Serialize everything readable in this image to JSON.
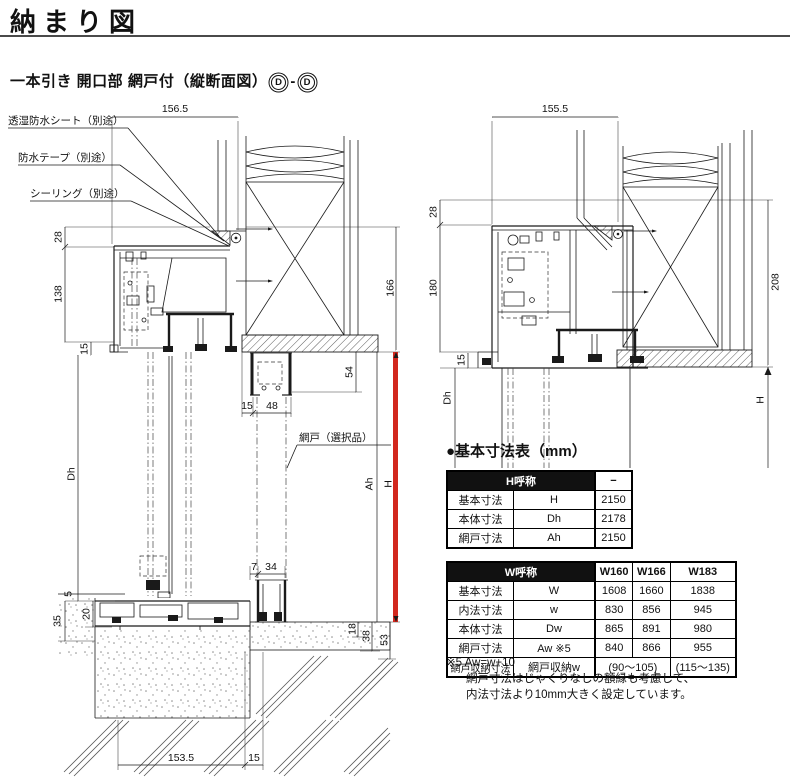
{
  "header": {
    "title": "納まり図"
  },
  "subtitle": {
    "text": "一本引き 開口部 網戸付（縦断面図）",
    "mark1": "D",
    "sep": "-",
    "mark2": "D"
  },
  "left_diagram": {
    "callouts": {
      "sheet": "透湿防水シート（別途）",
      "tape": "防水テープ（別途）",
      "sealing": "シーリング（別途）",
      "screen": "網戸（選択品）"
    },
    "dims": {
      "top_width": "156.5",
      "d28": "28",
      "d138": "138",
      "d15": "15",
      "dh": "Dh",
      "d5": "5",
      "d20": "20",
      "d35": "35",
      "d166": "166",
      "d54": "54",
      "ah": "Ah",
      "h": "H",
      "d18": "18",
      "d38": "38",
      "d53": "53",
      "d48": "48",
      "d7": "7",
      "d34": "34",
      "bottom_width": "153.5"
    }
  },
  "right_diagram": {
    "dims": {
      "top_width": "155.5",
      "d28": "28",
      "d180": "180",
      "d15": "15",
      "dh": "Dh",
      "d208": "208",
      "h": "H"
    }
  },
  "spec": {
    "section_title": "●基本寸法表（mm）",
    "h_table": {
      "header_name": "H呼称",
      "header_col": "−",
      "rows": [
        {
          "label": "基本寸法",
          "symbol": "H",
          "value": "2150"
        },
        {
          "label": "本体寸法",
          "symbol": "Dh",
          "value": "2178"
        },
        {
          "label": "網戸寸法",
          "symbol": "Ah",
          "value": "2150"
        }
      ]
    },
    "w_table": {
      "header_name": "W呼称",
      "cols": [
        "W160",
        "W166",
        "W183"
      ],
      "rows": [
        {
          "label": "基本寸法",
          "symbol": "W",
          "v0": "1608",
          "v1": "1660",
          "v2": "1838"
        },
        {
          "label": "内法寸法",
          "symbol": "w",
          "v0": "830",
          "v1": "856",
          "v2": "945"
        },
        {
          "label": "本体寸法",
          "symbol": "Dw",
          "v0": "865",
          "v1": "891",
          "v2": "980"
        },
        {
          "label": "網戸寸法",
          "symbol": "Aw ※5",
          "v0": "840",
          "v1": "866",
          "v2": "955"
        }
      ],
      "storage_row": {
        "label": "網戸収納寸法",
        "symbol": "網戸収納w",
        "low": "(90〜105)",
        "high": "(115〜135)"
      }
    },
    "notes": [
      "※5 Aw=w+10",
      "網戸寸法はじゃくりなしの額縁も考慮して、",
      "内法寸法より10mm大きく設定しています。"
    ]
  },
  "colors": {
    "accent_red": "#d2281e",
    "line": "#1a1a1a"
  }
}
